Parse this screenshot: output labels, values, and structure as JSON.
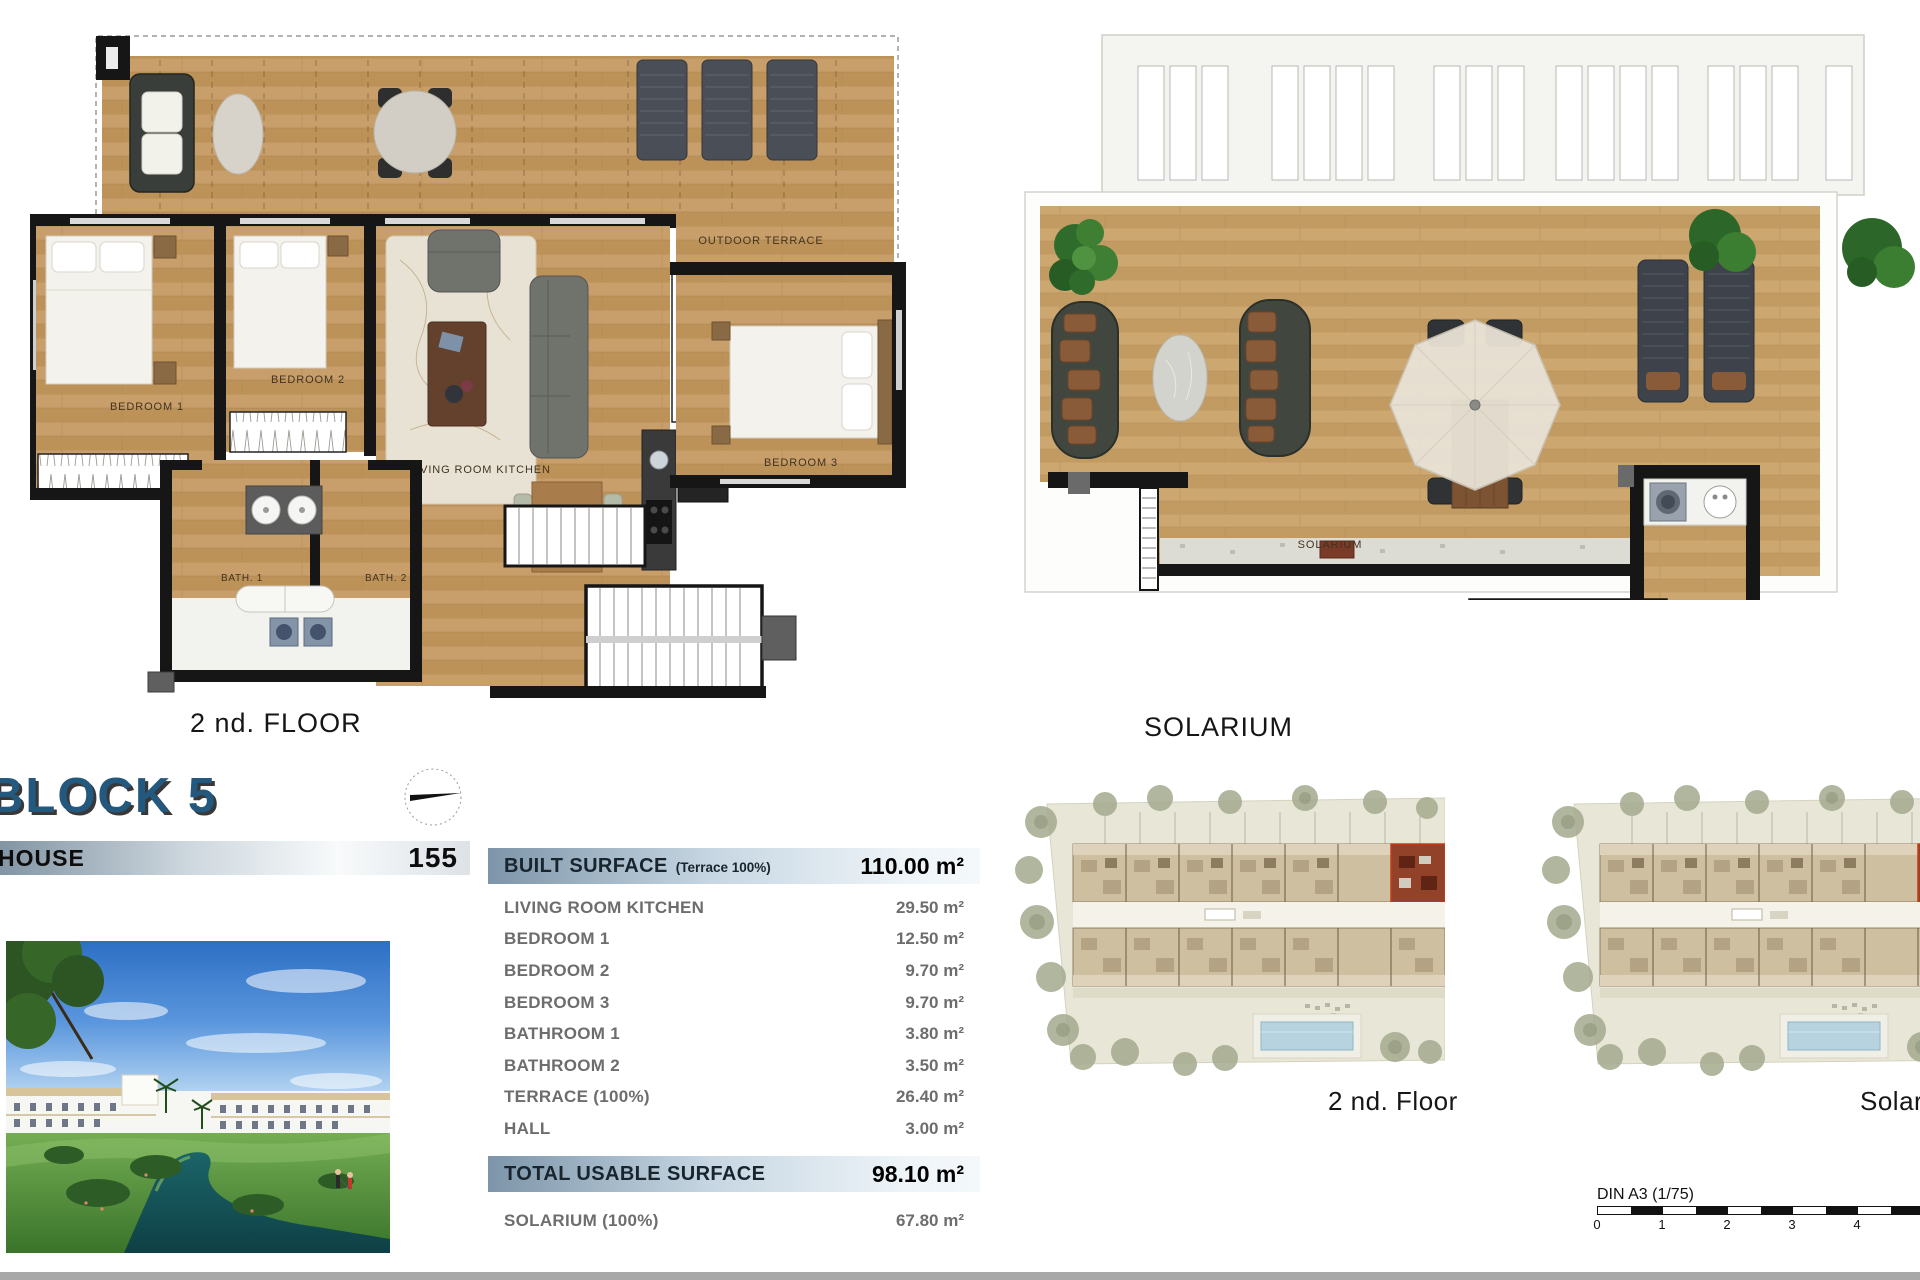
{
  "plans": {
    "second_floor": {
      "caption": "2 nd. FLOOR",
      "outdoor_terrace": "OUTDOOR TERRACE",
      "bedroom1": "BEDROOM 1",
      "bedroom2": "BEDROOM 2",
      "bedroom3": "BEDROOM 3",
      "living": "LIVING ROOM KITCHEN",
      "bath1": "BATH. 1",
      "bath2": "BATH. 2"
    },
    "solarium": {
      "caption": "SOLARIUM",
      "room": "SOLARIUM",
      "hall": "HALL"
    }
  },
  "header": {
    "block": "BLOCK 5",
    "house_label": "HOUSE",
    "house_number": "155"
  },
  "surfaces": {
    "built": {
      "label": "BUILT SURFACE",
      "note": "(Terrace 100%)",
      "value": "110.00 m²"
    },
    "rows": [
      {
        "label": "LIVING ROOM KITCHEN",
        "value": "29.50 m²"
      },
      {
        "label": "BEDROOM 1",
        "value": "12.50 m²"
      },
      {
        "label": "BEDROOM 2",
        "value": "9.70 m²"
      },
      {
        "label": "BEDROOM 3",
        "value": "9.70 m²"
      },
      {
        "label": "BATHROOM 1",
        "value": "3.80 m²"
      },
      {
        "label": "BATHROOM 2",
        "value": "3.50 m²"
      },
      {
        "label": "TERRACE (100%)",
        "value": "26.40 m²"
      },
      {
        "label": "HALL",
        "value": "3.00 m²"
      }
    ],
    "total": {
      "label": "TOTAL USABLE SURFACE",
      "value": "98.10 m²"
    },
    "solarium_row": {
      "label": "SOLARIUM (100%)",
      "value": "67.80 m²"
    }
  },
  "site": {
    "floor_caption": "2 nd. Floor",
    "solarium_caption": "Solarium",
    "scale_label": "DIN A3 (1/75)",
    "ticks": [
      "0",
      "1",
      "2",
      "3",
      "4"
    ]
  },
  "colors": {
    "accent_blue": "#23597f",
    "bar_gradient_start": "#7d95a9",
    "bar_gradient_end": "#f4f8fb",
    "wood": "#c39862",
    "wall": "#161616",
    "highlight_unit": "#93422a",
    "pool": "#b7d3e0",
    "bottom_strip": "#a8a8a8"
  }
}
